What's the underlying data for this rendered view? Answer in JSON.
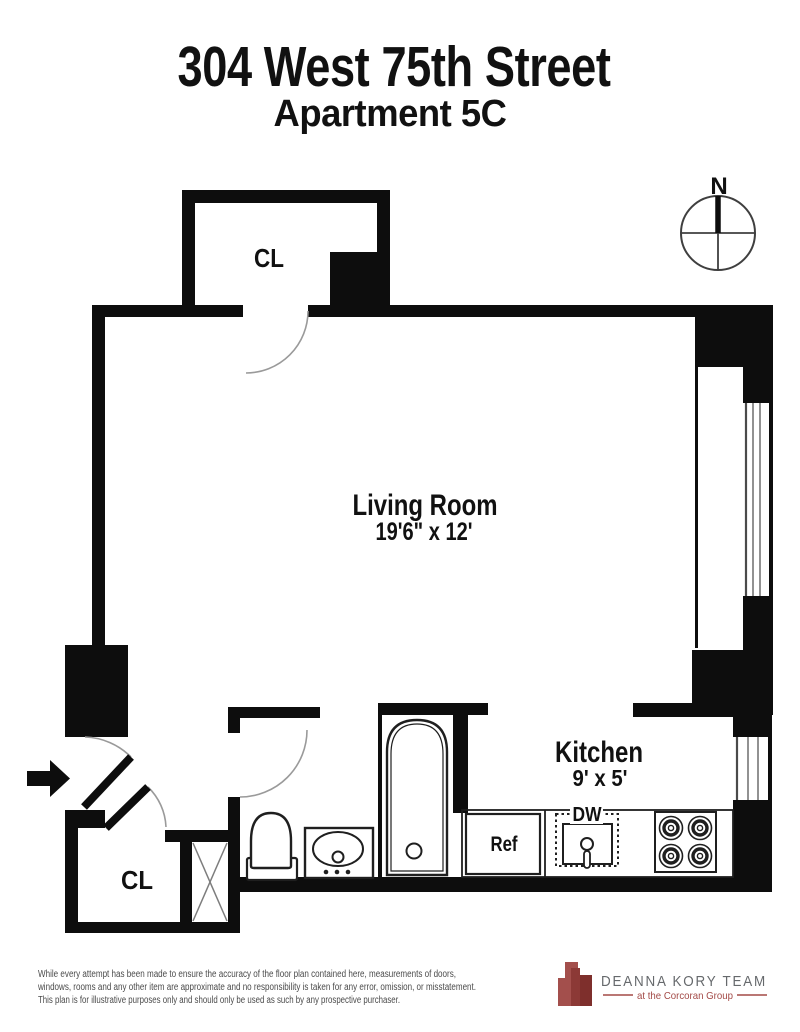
{
  "header": {
    "address": "304 West 75th Street",
    "unit": "Apartment 5C"
  },
  "compass": {
    "north_label": "N"
  },
  "rooms": {
    "living": {
      "name": "Living Room",
      "dims": "19'6\" x 12'"
    },
    "kitchen": {
      "name": "Kitchen",
      "dims": "9' x 5'"
    },
    "closet_top": {
      "label": "CL"
    },
    "closet_entry": {
      "label": "CL"
    }
  },
  "fixtures": {
    "refrigerator": "Ref",
    "dishwasher": "DW"
  },
  "disclaimer": {
    "lines": [
      "While every attempt has been made to ensure the accuracy of the floor plan contained here, measurements of doors,",
      "windows, rooms and any other item are approximate and no responsibility is taken for any error, omission, or misstatement.",
      "This plan is for illustrative purposes only and should only be used as such by any prospective purchaser."
    ]
  },
  "logo": {
    "team": "DEANNA KORY TEAM",
    "tagline": "at the Corcoran Group"
  },
  "colors": {
    "wall": "#0d0d0d",
    "fixture_line": "#1f1f1f",
    "arc": "#9a9a9a",
    "maroon": "#9c4340",
    "logo_gray": "#66696c"
  }
}
